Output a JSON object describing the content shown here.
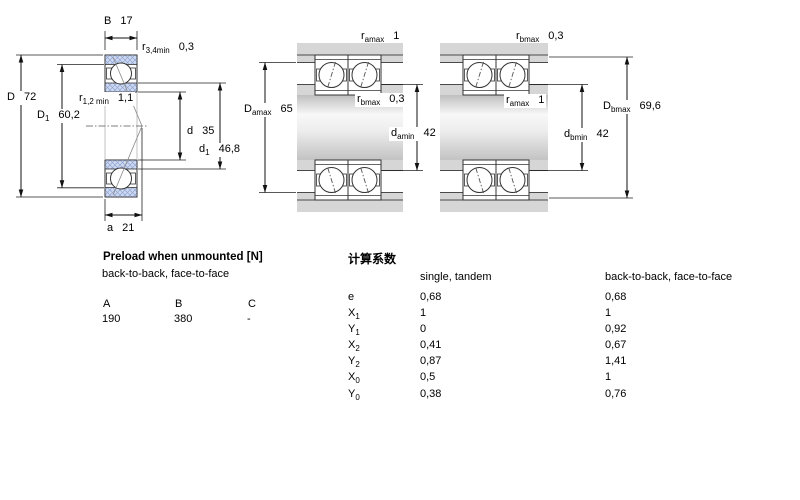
{
  "figures": {
    "left": {
      "B": {
        "b": "B",
        "s": "",
        "v": "17"
      },
      "r34": {
        "b": "r",
        "s": "3,4min",
        "v": "0,3"
      },
      "D": {
        "b": "D",
        "s": "",
        "v": "72"
      },
      "r12": {
        "b": "r",
        "s": "1,2 min",
        "v": "1,1"
      },
      "D1": {
        "b": "D",
        "s": "1",
        "v": "60,2"
      },
      "d": {
        "b": "d",
        "s": "",
        "v": "35"
      },
      "d1": {
        "b": "d",
        "s": "1",
        "v": "46,8"
      },
      "a": {
        "b": "a",
        "s": "",
        "v": "21"
      }
    },
    "middle": {
      "ra": {
        "b": "r",
        "s": "amax",
        "v": "1"
      },
      "Da": {
        "b": "D",
        "s": "amax",
        "v": "65"
      },
      "rb": {
        "b": "r",
        "s": "bmax",
        "v": "0,3"
      },
      "da": {
        "b": "d",
        "s": "amin",
        "v": "42"
      }
    },
    "right": {
      "rb": {
        "b": "r",
        "s": "bmax",
        "v": "0,3"
      },
      "ra": {
        "b": "r",
        "s": "amax",
        "v": "1"
      },
      "Db": {
        "b": "D",
        "s": "bmax",
        "v": "69,6"
      },
      "db": {
        "b": "d",
        "s": "bmin",
        "v": "42"
      }
    }
  },
  "preload": {
    "title": "Preload when unmounted [N]",
    "subtitle": "back-to-back, face-to-face",
    "col_a": "A",
    "col_b": "B",
    "col_c": "C",
    "val_a": "190",
    "val_b": "380",
    "val_c": "-"
  },
  "factors": {
    "title": "计算系数",
    "col1": "single, tandem",
    "col2": "back-to-back, face-to-face",
    "rows": [
      {
        "b": "e",
        "s": "",
        "v1": "0,68",
        "v2": "0,68"
      },
      {
        "b": "X",
        "s": "1",
        "v1": "1",
        "v2": "1"
      },
      {
        "b": "Y",
        "s": "1",
        "v1": "0",
        "v2": "0,92"
      },
      {
        "b": "X",
        "s": "2",
        "v1": "0,41",
        "v2": "0,67"
      },
      {
        "b": "Y",
        "s": "2",
        "v1": "0,87",
        "v2": "1,41"
      },
      {
        "b": "X",
        "s": "0",
        "v1": "0,5",
        "v2": "1"
      },
      {
        "b": "Y",
        "s": "0",
        "v1": "0,38",
        "v2": "0,76"
      }
    ]
  },
  "colors": {
    "hatch_fill": "#cfdaf2",
    "hatch_line": "#90a5d2",
    "housing_gray": "#d6d6d6",
    "line_dark": "#333333"
  }
}
